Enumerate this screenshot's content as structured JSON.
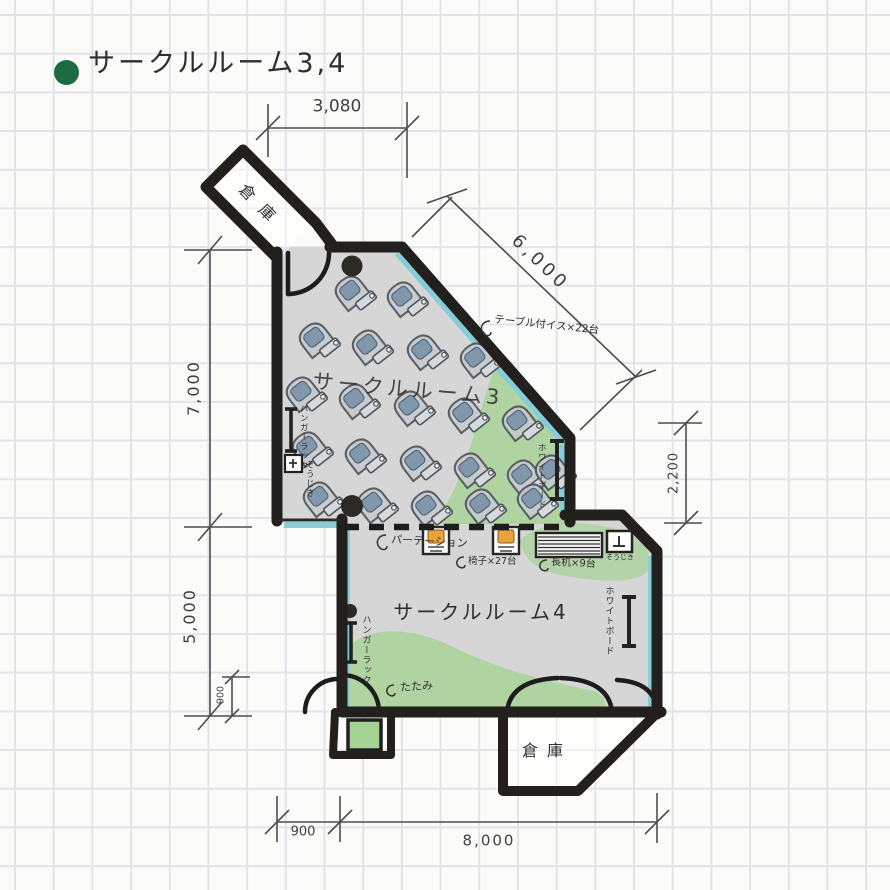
{
  "title": {
    "text": "サークルルーム3,4",
    "bullet_color": "#1d6b40"
  },
  "rooms": {
    "room3": {
      "name": "サークルルーム3"
    },
    "room4": {
      "name": "サークルルーム4"
    },
    "storage_upper": {
      "name": "倉庫"
    },
    "storage_lower": {
      "name": "倉庫"
    }
  },
  "dimensions": {
    "top_width": "3,080",
    "diagonal_wall": "6,000",
    "left_upper_height": "7,000",
    "left_lower_height": "5,000",
    "left_small": "900",
    "right_height": "2,200",
    "bottom_left_width": "900",
    "bottom_width": "8,000"
  },
  "annotations": {
    "tablet_chairs": "テーブル付イス×22台",
    "partition": "パーテーション",
    "stacked_chairs": "椅子×27台",
    "long_desks": "長机×9台",
    "vacuum_upper": "そうじき",
    "vacuum_lower": "そうじき",
    "hanger_rack_room3": "ハンガーラック",
    "hanger_rack_room4": "ハンガーラック",
    "whiteboard_room3": "ホワイトボード",
    "whiteboard_room4": "ホワイトボード",
    "tatami": "たたみ"
  },
  "legend_colors": {
    "wall": "#221f1c",
    "highlight_green": "#a6d295",
    "wall_accent_cyan": "#87ccd9",
    "chair_seat_blue": "#7e96ab",
    "stacked_chair_orange": "#e9a33c"
  }
}
